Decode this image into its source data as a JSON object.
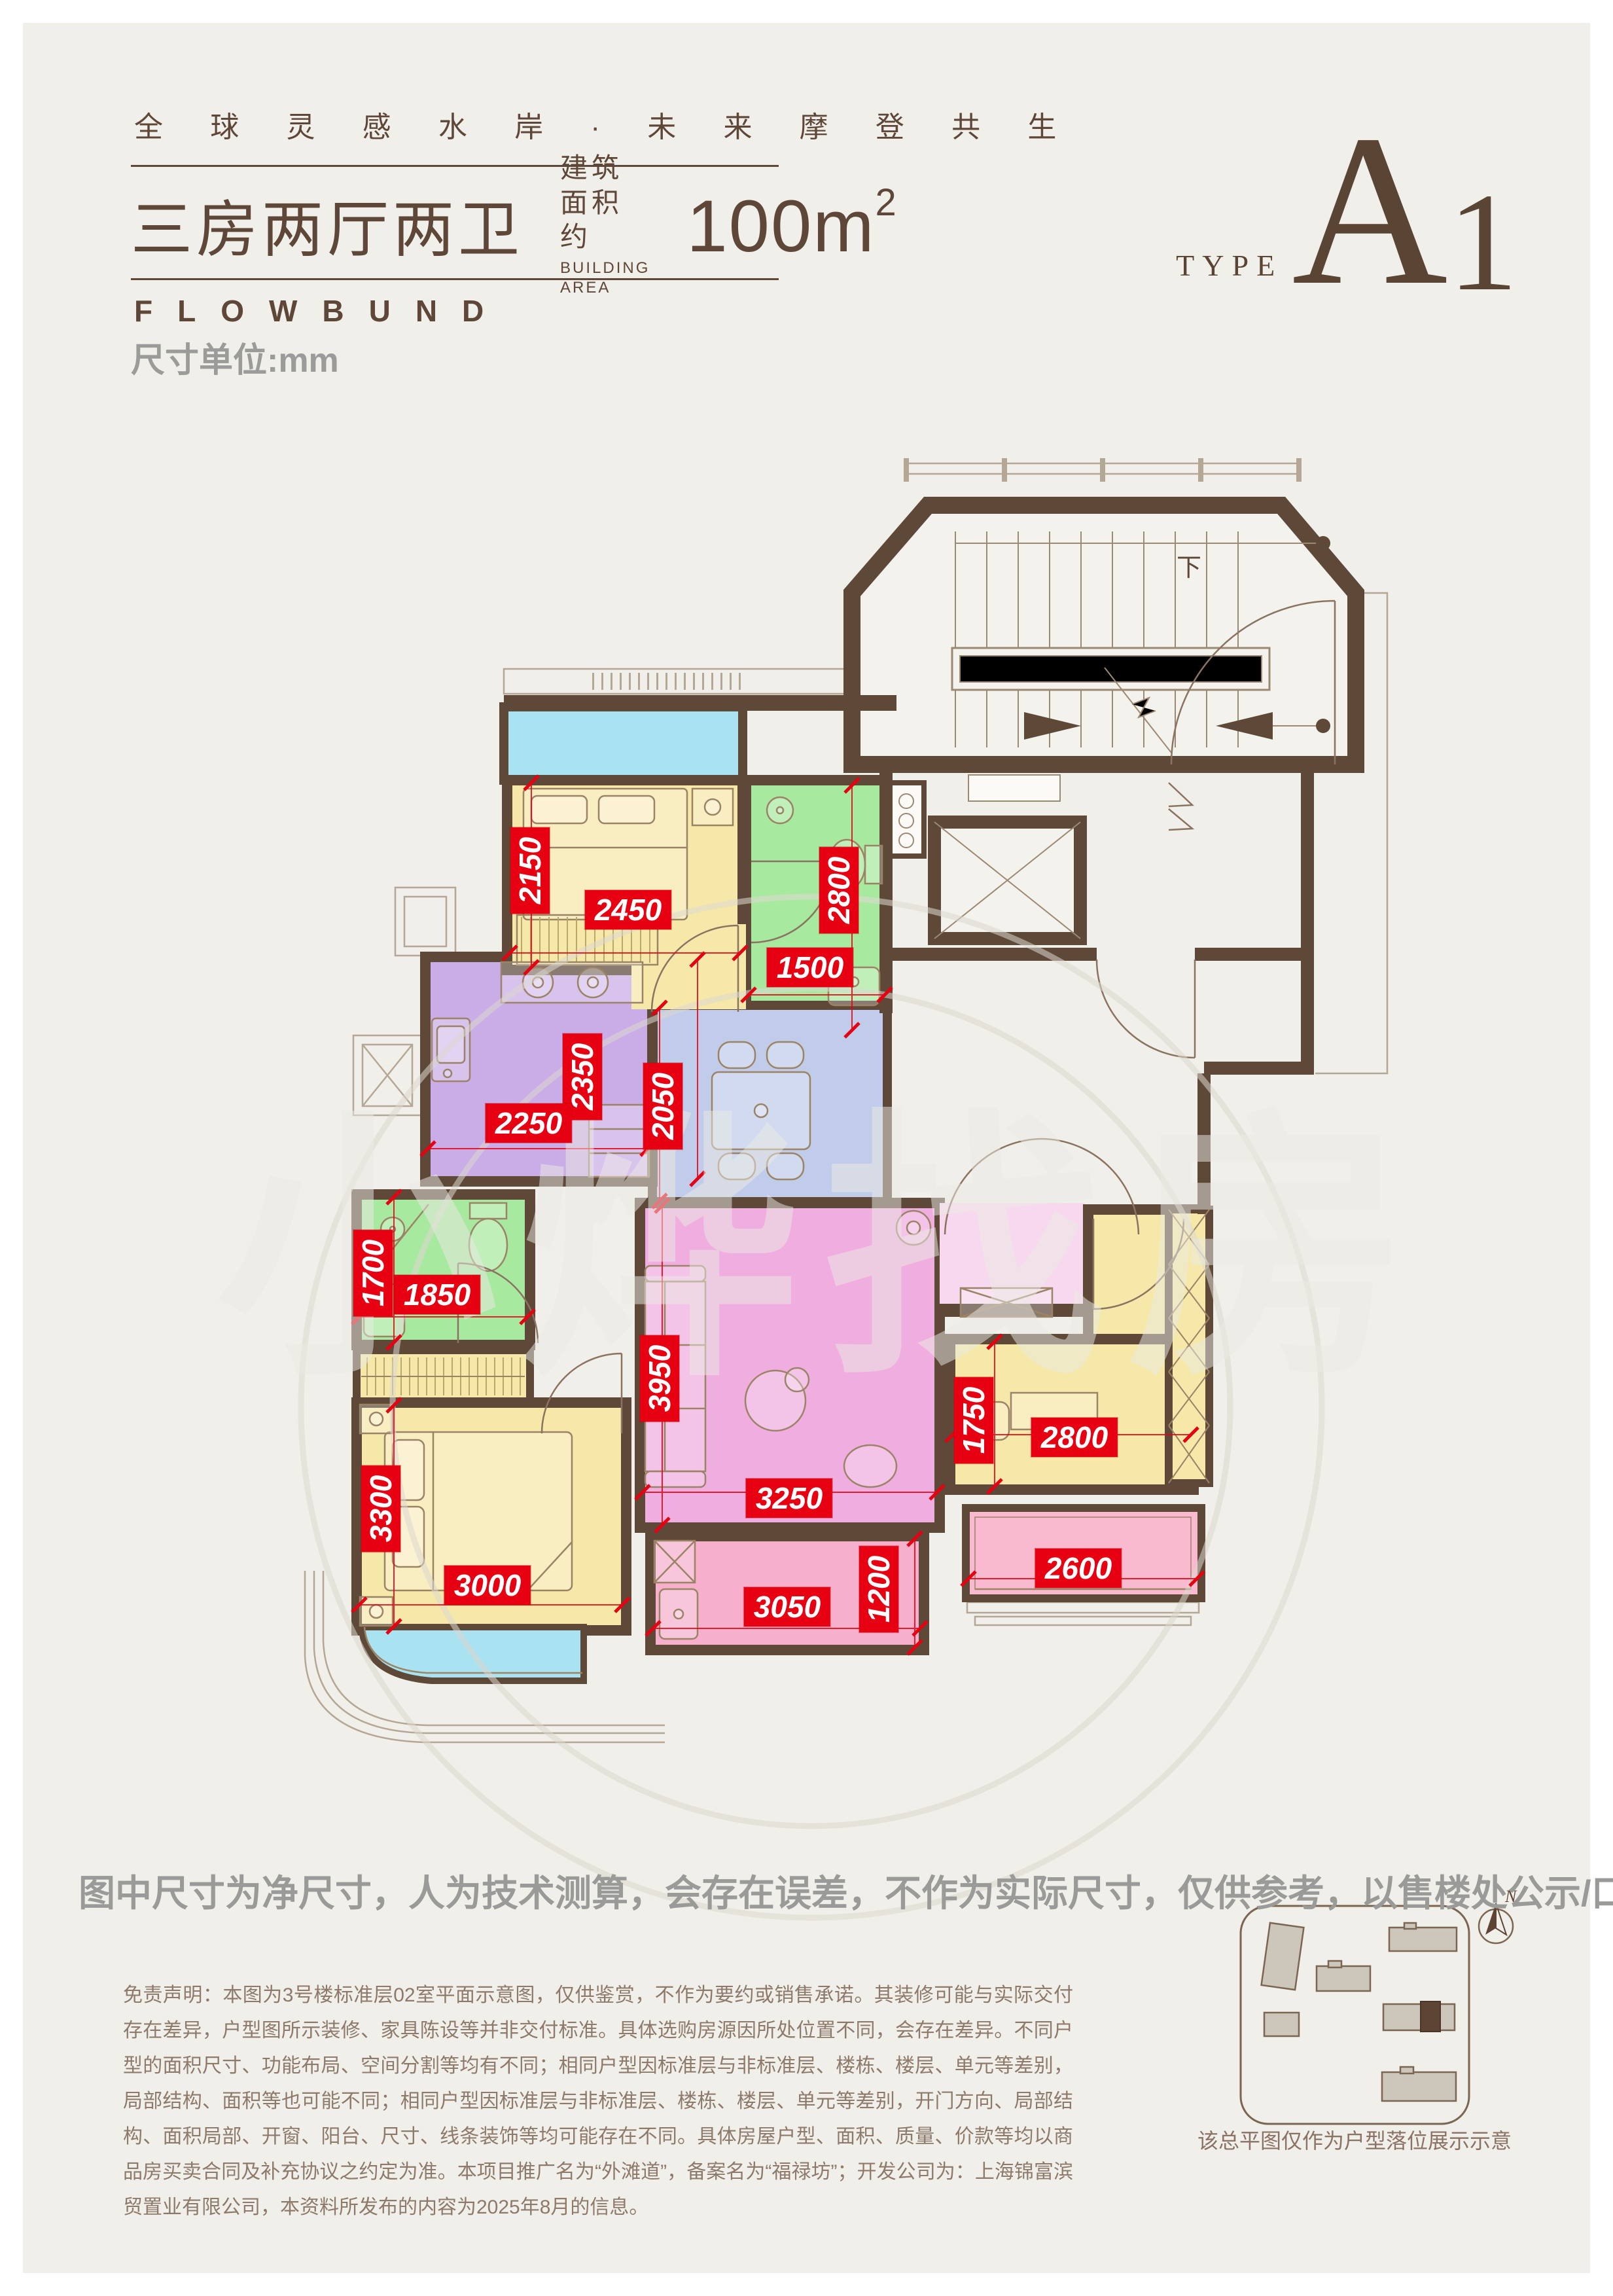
{
  "header": {
    "slogan": "全 球 灵 感 水 岸 · 未 来 摩 登 共 生",
    "title": "三房两厅两卫",
    "area_label_cn": "建筑面积约",
    "area_label_en": "BUILDING AREA",
    "area_value": "100m",
    "area_sup": "2",
    "brand": "FLOWBUND",
    "unit_note": "尺寸单位:mm",
    "type_label": "TYPE",
    "type_value_a": "A",
    "type_value_1": "1"
  },
  "plan": {
    "watermark": "小烨找房",
    "stair_down_label": "下",
    "dims": [
      {
        "value": "2150",
        "orient": "v"
      },
      {
        "value": "2450",
        "orient": "h"
      },
      {
        "value": "2800",
        "orient": "v"
      },
      {
        "value": "1500",
        "orient": "h"
      },
      {
        "value": "2350",
        "orient": "v"
      },
      {
        "value": "2250",
        "orient": "h"
      },
      {
        "value": "2050",
        "orient": "v"
      },
      {
        "value": "1700",
        "orient": "v"
      },
      {
        "value": "1850",
        "orient": "h"
      },
      {
        "value": "3950",
        "orient": "v"
      },
      {
        "value": "3250",
        "orient": "h"
      },
      {
        "value": "1750",
        "orient": "v"
      },
      {
        "value": "2800",
        "orient": "h"
      },
      {
        "value": "3300",
        "orient": "v"
      },
      {
        "value": "3000",
        "orient": "h"
      },
      {
        "value": "3050",
        "orient": "h"
      },
      {
        "value": "1200",
        "orient": "v"
      },
      {
        "value": "2600",
        "orient": "h"
      }
    ]
  },
  "footer": {
    "bold_note": "图中尺寸为净尺寸，人为技术测算，会存在误差，不作为实际尺寸，仅供参考，以售楼处公示/口径为准",
    "disclaimer": "免责声明：本图为3号楼标准层02室平面示意图，仅供鉴赏，不作为要约或销售承诺。其装修可能与实际交付存在差异，户型图所示装修、家具陈设等并非交付标准。具体选购房源因所处位置不同，会存在差异。不同户型的面积尺寸、功能布局、空间分割等均有不同；相同户型因标准层与非标准层、楼栋、楼层、单元等差别，局部结构、面积等也可能不同；相同户型因标准层与非标准层、楼栋、楼层、单元等差别，开门方向、局部结构、面积局部、开窗、阳台、尺寸、线条装饰等均可能存在不同。具体房屋户型、面积、质量、价款等均以商品房买卖合同及补充协议之约定为准。本项目推广名为“外滩道”，备案名为“福禄坊”；开发公司为：上海锦富滨贸置业有限公司，本资料所发布的内容为2025年8月的信息。",
    "siteplan_caption": "该总平图仅作为户型落位展示示意",
    "north_label": "N"
  },
  "colors": {
    "accent_red": "#e60012",
    "wall_brown": "#5e4939",
    "text_brown": "#5e4738",
    "note_gray": "#9a9a98",
    "bedroom_yellow": "#f5e8a9",
    "bath_green": "#a8e9a0",
    "kitchen_purple": "#caace7",
    "dining_blue": "#c0cce9",
    "living_pink": "#f0aee0",
    "balcony_cyan": "#a9e2f1",
    "balcony_pink": "#f9b9cf"
  }
}
